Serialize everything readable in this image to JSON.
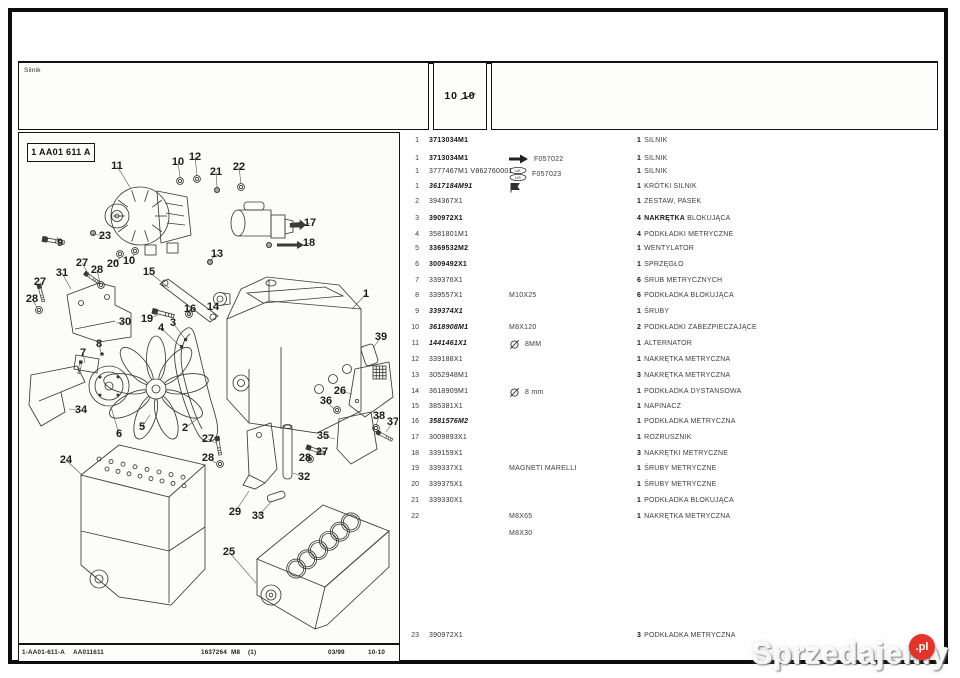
{
  "header": {
    "section_label": "Silnik",
    "page_a": "10",
    "page_b": "10"
  },
  "diagram": {
    "ref_label": "1 AA01 611 A",
    "callouts": [
      {
        "n": "11",
        "x": 98,
        "y": 36,
        "tx": 112,
        "ty": 56
      },
      {
        "n": "10",
        "x": 159,
        "y": 32,
        "tx": 161,
        "ty": 44
      },
      {
        "n": "12",
        "x": 176,
        "y": 27,
        "tx": 178,
        "ty": 42
      },
      {
        "n": "21",
        "x": 197,
        "y": 42,
        "tx": 198,
        "ty": 54
      },
      {
        "n": "22",
        "x": 220,
        "y": 37,
        "tx": 222,
        "ty": 51
      },
      {
        "n": "9",
        "x": 41,
        "y": 113,
        "tx": 38,
        "ty": 104
      },
      {
        "n": "23",
        "x": 86,
        "y": 106,
        "tx": 74,
        "ty": 101
      },
      {
        "n": "17",
        "x": 291,
        "y": 93,
        "tx": 286,
        "ty": 92
      },
      {
        "n": "18",
        "x": 290,
        "y": 113,
        "tx": 285,
        "ty": 112
      },
      {
        "n": "20",
        "x": 94,
        "y": 134,
        "tx": 101,
        "ty": 125
      },
      {
        "n": "10",
        "x": 110,
        "y": 131,
        "tx": 115,
        "ty": 122
      },
      {
        "n": "27",
        "x": 63,
        "y": 133,
        "tx": 71,
        "ty": 144
      },
      {
        "n": "28",
        "x": 78,
        "y": 140,
        "tx": 81,
        "ty": 150
      },
      {
        "n": "31",
        "x": 43,
        "y": 143,
        "tx": 52,
        "ty": 156
      },
      {
        "n": "27",
        "x": 21,
        "y": 152,
        "tx": 23,
        "ty": 160
      },
      {
        "n": "28",
        "x": 13,
        "y": 169,
        "tx": 18,
        "ty": 174
      },
      {
        "n": "15",
        "x": 130,
        "y": 142,
        "tx": 150,
        "ty": 155
      },
      {
        "n": "13",
        "x": 198,
        "y": 124,
        "tx": 191,
        "ty": 128
      },
      {
        "n": "14",
        "x": 194,
        "y": 177,
        "tx": 200,
        "ty": 170
      },
      {
        "n": "16",
        "x": 171,
        "y": 179,
        "tx": 170,
        "ty": 182
      },
      {
        "n": "19",
        "x": 128,
        "y": 189,
        "tx": 139,
        "ty": 182
      },
      {
        "n": "30",
        "x": 106,
        "y": 192,
        "tx": 97,
        "ty": 190
      },
      {
        "n": "7",
        "x": 64,
        "y": 223,
        "tx": 66,
        "ty": 230
      },
      {
        "n": "8",
        "x": 80,
        "y": 214,
        "tx": 82,
        "ty": 220
      },
      {
        "n": "3",
        "x": 154,
        "y": 193,
        "tx": 166,
        "ty": 206
      },
      {
        "n": "4",
        "x": 142,
        "y": 198,
        "tx": 161,
        "ty": 213
      },
      {
        "n": "1",
        "x": 347,
        "y": 164,
        "tx": 333,
        "ty": 176
      },
      {
        "n": "39",
        "x": 362,
        "y": 207,
        "tx": 354,
        "ty": 215
      },
      {
        "n": "26",
        "x": 321,
        "y": 261,
        "tx": 333,
        "ty": 261
      },
      {
        "n": "36",
        "x": 307,
        "y": 271,
        "tx": 315,
        "ty": 276
      },
      {
        "n": "38",
        "x": 360,
        "y": 286,
        "tx": 357,
        "ty": 293
      },
      {
        "n": "37",
        "x": 374,
        "y": 292,
        "tx": 367,
        "ty": 299
      },
      {
        "n": "35",
        "x": 304,
        "y": 306,
        "tx": 316,
        "ty": 306
      },
      {
        "n": "27",
        "x": 303,
        "y": 322,
        "tx": 296,
        "ty": 319
      },
      {
        "n": "28",
        "x": 286,
        "y": 328,
        "tx": 290,
        "ty": 325
      },
      {
        "n": "34",
        "x": 62,
        "y": 280,
        "tx": 50,
        "ty": 276
      },
      {
        "n": "6",
        "x": 100,
        "y": 304,
        "tx": 92,
        "ty": 274
      },
      {
        "n": "5",
        "x": 123,
        "y": 297,
        "tx": 131,
        "ty": 282
      },
      {
        "n": "2",
        "x": 166,
        "y": 298,
        "tx": 178,
        "ty": 286
      },
      {
        "n": "27",
        "x": 189,
        "y": 309,
        "tx": 197,
        "ty": 310
      },
      {
        "n": "28",
        "x": 189,
        "y": 328,
        "tx": 197,
        "ty": 330
      },
      {
        "n": "24",
        "x": 47,
        "y": 330,
        "tx": 63,
        "ty": 342
      },
      {
        "n": "32",
        "x": 285,
        "y": 347,
        "tx": 274,
        "ty": 340
      },
      {
        "n": "29",
        "x": 216,
        "y": 382,
        "tx": 230,
        "ty": 358
      },
      {
        "n": "33",
        "x": 239,
        "y": 386,
        "tx": 253,
        "ty": 368
      },
      {
        "n": "25",
        "x": 210,
        "y": 422,
        "tx": 237,
        "ty": 450
      }
    ]
  },
  "table": {
    "rows": [
      {
        "y": 136,
        "i": "1",
        "p": "3713034M1",
        "s": "b",
        "mi": "",
        "m": "",
        "q": "1",
        "ds": "",
        "d": "SILNIK"
      },
      {
        "y": 154,
        "i": "1",
        "p": "3713034M1",
        "s": "b",
        "mi": "arrow",
        "m": "F057022",
        "q": "1",
        "ds": "",
        "d": "SILNIK"
      },
      {
        "y": 167,
        "i": "1",
        "p": "3777467M1 V862760001",
        "s": "r",
        "mi": "ukus",
        "m": "F057023",
        "q": "1",
        "ds": "",
        "d": "SILNIK"
      },
      {
        "y": 182,
        "i": "1",
        "p": "3617184M91",
        "s": "bi",
        "mi": "flag",
        "m": "",
        "q": "1",
        "ds": "",
        "d": "KRÓTKI SILNIK"
      },
      {
        "y": 197,
        "i": "2",
        "p": "394367X1",
        "s": "r",
        "mi": "",
        "m": "",
        "q": "1",
        "ds": "",
        "d": "ZESTAW, PASEK"
      },
      {
        "y": 214,
        "i": "3",
        "p": "390972X1",
        "s": "b",
        "mi": "",
        "m": "",
        "q": "4",
        "ds": "NAKRĘTKA",
        "d": " BLOKUJĄCA"
      },
      {
        "y": 230,
        "i": "4",
        "p": "3581801M1",
        "s": "r",
        "mi": "",
        "m": "",
        "q": "4",
        "ds": "",
        "d": "PODKŁADKI METRYCZNE"
      },
      {
        "y": 244,
        "i": "5",
        "p": "3369532M2",
        "s": "b",
        "mi": "",
        "m": "",
        "q": "1",
        "ds": "",
        "d": "WENTYLATOR"
      },
      {
        "y": 260,
        "i": "6",
        "p": "3009492X1",
        "s": "b",
        "mi": "",
        "m": "",
        "q": "1",
        "ds": "",
        "d": "SPRZĘGŁO"
      },
      {
        "y": 276,
        "i": "7",
        "p": "339376X1",
        "s": "r",
        "mi": "",
        "m": "",
        "q": "6",
        "ds": "",
        "d": "ŚRUB METRYCZNYCH"
      },
      {
        "y": 291,
        "i": "8",
        "p": "339557X1",
        "s": "r",
        "mi": "",
        "m": "M10X25",
        "q": "6",
        "ds": "",
        "d": "PODKŁADKA BLOKUJĄCA"
      },
      {
        "y": 307,
        "i": "9",
        "p": "339374X1",
        "s": "bi",
        "mi": "",
        "m": "",
        "q": "1",
        "ds": "",
        "d": "ŚRUBY"
      },
      {
        "y": 323,
        "i": "10",
        "p": "3618908M1",
        "s": "bi",
        "mi": "",
        "m": "M8X120",
        "q": "2",
        "ds": "",
        "d": "PODKŁADKI ZABEZPIECZAJĄCE"
      },
      {
        "y": 339,
        "i": "11",
        "p": "1441461X1",
        "s": "bi",
        "mi": "dia",
        "m": "8MM",
        "q": "1",
        "ds": "",
        "d": "ALTERNATOR"
      },
      {
        "y": 355,
        "i": "12",
        "p": "339188X1",
        "s": "r",
        "mi": "",
        "m": "",
        "q": "1",
        "ds": "",
        "d": "NAKRĘTKA METRYCZNA"
      },
      {
        "y": 371,
        "i": "13",
        "p": "3052948M1",
        "s": "r",
        "mi": "",
        "m": "",
        "q": "3",
        "ds": "",
        "d": "NAKRĘTKA METRYCZNA"
      },
      {
        "y": 387,
        "i": "14",
        "p": "3618909M1",
        "s": "r",
        "mi": "dia",
        "m": "8 mm",
        "q": "1",
        "ds": "",
        "d": "PODKŁADKA DYSTANSOWA"
      },
      {
        "y": 402,
        "i": "15",
        "p": "385381X1",
        "s": "r",
        "mi": "",
        "m": "",
        "q": "1",
        "ds": "",
        "d": "NAPINACZ"
      },
      {
        "y": 417,
        "i": "16",
        "p": "3581576M2",
        "s": "bi",
        "mi": "",
        "m": "",
        "q": "1",
        "ds": "",
        "d": "PODKŁADKA METRYCZNA"
      },
      {
        "y": 433,
        "i": "17",
        "p": "3009893X1",
        "s": "r",
        "mi": "",
        "m": "",
        "q": "1",
        "ds": "",
        "d": "ROZRUSZNIK"
      },
      {
        "y": 449,
        "i": "18",
        "p": "339159X1",
        "s": "r",
        "mi": "",
        "m": "",
        "q": "3",
        "ds": "",
        "d": "NAKRĘTKI METRYCZNE"
      },
      {
        "y": 464,
        "i": "19",
        "p": "339337X1",
        "s": "r",
        "mi": "",
        "m": "MAGNETI MARELLI",
        "q": "1",
        "ds": "",
        "d": "ŚRUBY METRYCZNE"
      },
      {
        "y": 480,
        "i": "20",
        "p": "339375X1",
        "s": "r",
        "mi": "",
        "m": "",
        "q": "1",
        "ds": "",
        "d": "ŚRUBY METRYCZNE"
      },
      {
        "y": 496,
        "i": "21",
        "p": "339330X1",
        "s": "r",
        "mi": "",
        "m": "",
        "q": "1",
        "ds": "",
        "d": "PODKŁADKA BLOKUJĄCA"
      },
      {
        "y": 512,
        "i": "22",
        "p": "",
        "s": "r",
        "mi": "",
        "m": "M8X65",
        "q": "1",
        "ds": "",
        "d": "NAKRĘTKA METRYCZNA"
      },
      {
        "y": 529,
        "i": "",
        "p": "",
        "s": "r",
        "mi": "",
        "m": "M8X30",
        "q": "",
        "ds": "",
        "d": ""
      },
      {
        "y": 631,
        "i": "23",
        "p": "390972X1",
        "s": "r",
        "mi": "",
        "m": "",
        "q": "3",
        "ds": "",
        "d": "PODKŁADKA METRYCZNA"
      }
    ]
  },
  "footer": {
    "ref1": "1-AA01-611-A",
    "ref2": "AA011611",
    "num": "1637264",
    "size": "M8",
    "rev": "(1)",
    "date": "03/99",
    "page": "10-10"
  },
  "watermark": {
    "text": "Sprzedajemy",
    "badge": ".pl",
    "badge_color": "#e2342b"
  }
}
